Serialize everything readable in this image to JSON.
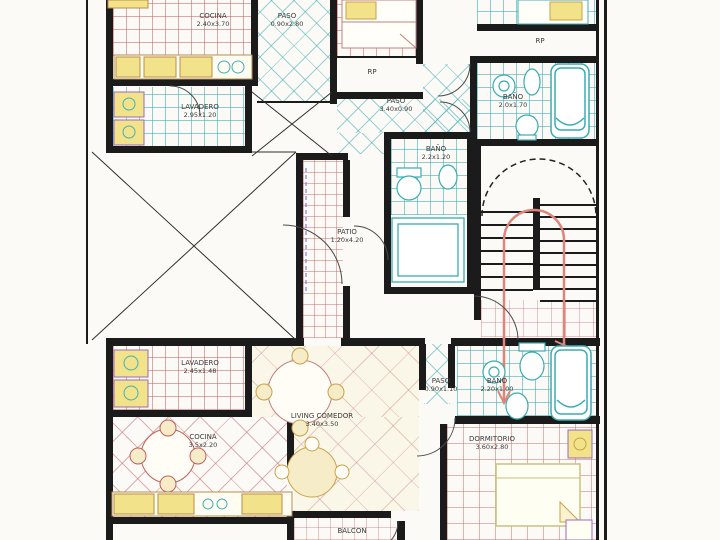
{
  "drawing": {
    "type": "architectural-floor-plan",
    "colors": {
      "wall": "#1b1b1b",
      "tile_pink": "#c36464",
      "tile_cyan": "#46afb4",
      "fixture_yellow": "#f2e38a",
      "stair_arrow_red": "#e0837a",
      "dashed_purple": "#8a7ad0"
    },
    "fixture_icons": [
      "bathtub-icon",
      "toilet-icon",
      "bidet-icon",
      "sink-icon",
      "bed-icon",
      "dining-table-icon",
      "kitchen-counter-icon",
      "laundry-tub-icon",
      "stairs",
      "stair-direction-arrow-icon",
      "door-swing-arc",
      "void-cross-marks"
    ]
  },
  "rooms": [
    {
      "label": "COCINA",
      "dims": "2.40x3.70"
    },
    {
      "label": "PASO",
      "dims": "0.90x2.80"
    },
    {
      "label": "LAVADERO",
      "dims": "2.95x1.20"
    },
    {
      "label": "RP",
      "dims": ""
    },
    {
      "label": "RP",
      "dims": ""
    },
    {
      "label": "BAÑO",
      "dims": "2.0x1.70"
    },
    {
      "label": "PASO",
      "dims": "3.40x0.90"
    },
    {
      "label": "BAÑO",
      "dims": "2.2x1.20"
    },
    {
      "label": "PATIO",
      "dims": "1.20x4.20"
    },
    {
      "label": "LAVADERO",
      "dims": "2.45x1.48"
    },
    {
      "label": "COCINA",
      "dims": "3.5x2.20"
    },
    {
      "label": "LIVING COMEDOR",
      "dims": "3.40x3.50"
    },
    {
      "label": "PASO",
      "dims": "0.90x1.10"
    },
    {
      "label": "BAÑO",
      "dims": "2.20x1.00"
    },
    {
      "label": "DORMITORIO",
      "dims": "3.60x2.80"
    },
    {
      "label": "BALCON",
      "dims": ""
    }
  ]
}
